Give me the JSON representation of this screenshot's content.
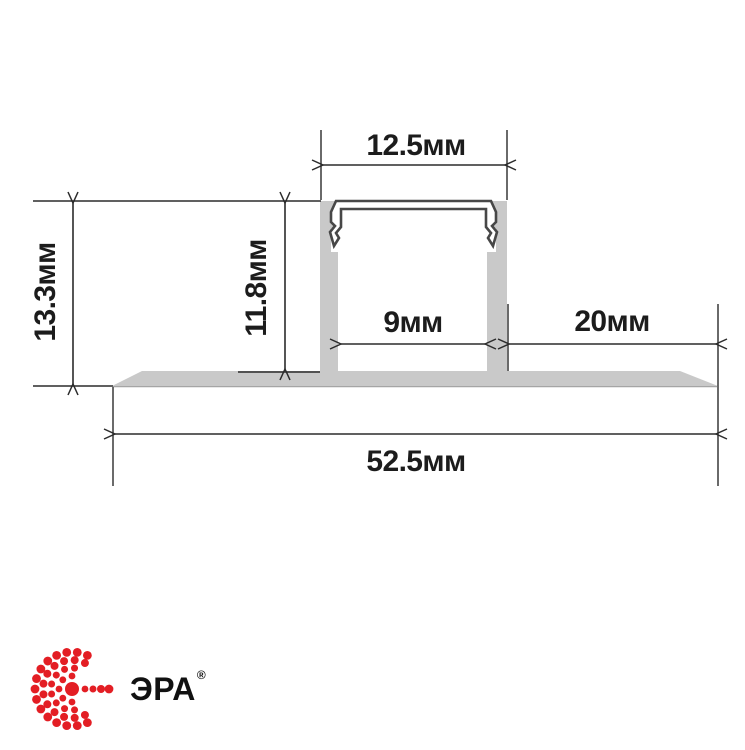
{
  "drawing": {
    "type": "led-profile-cross-section",
    "unit": "мм",
    "dimension_labels": {
      "cover_width": "12.5мм",
      "overall_height": "13.3мм",
      "recess_height": "11.8мм",
      "channel_inner_width": "9мм",
      "right_flange_width": "20мм",
      "overall_width": "52.5мм"
    },
    "colors": {
      "profile_fill": "#c9c9c9",
      "profile_outline": "#474747",
      "dimension_lines": "#2b2b2b",
      "label_text": "#1c1c1c"
    }
  },
  "brand": {
    "name": "ЭРА",
    "registered_mark": "®",
    "logo_color": "#e31e24",
    "logo_icon": "era-dotted-circle-icon"
  }
}
